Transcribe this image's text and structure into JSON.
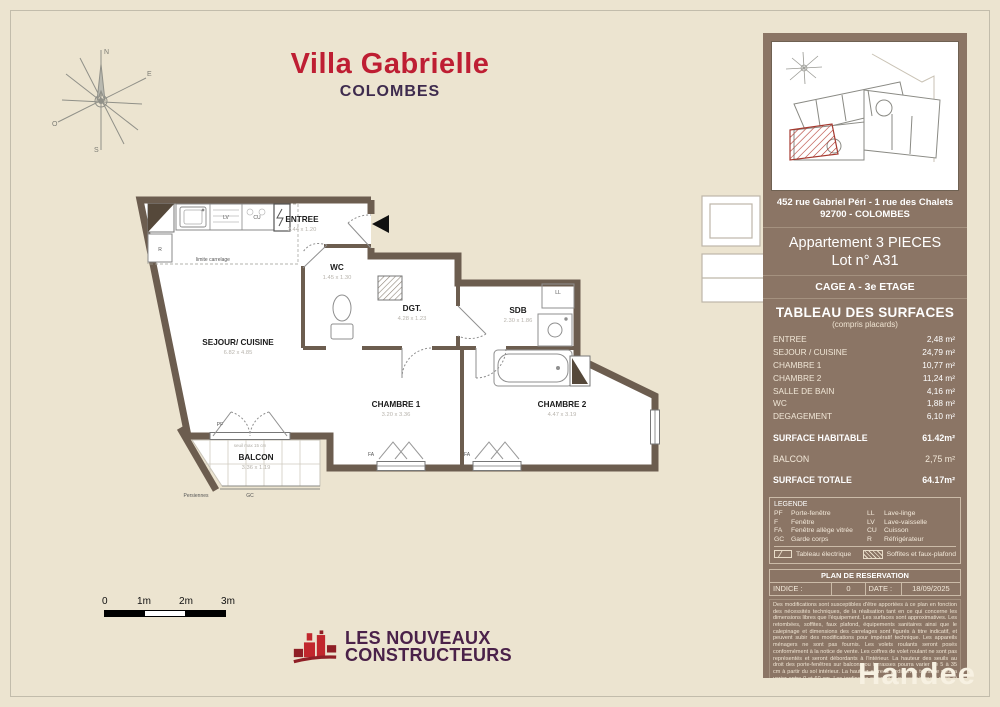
{
  "page": {
    "watermark": "Handee"
  },
  "header": {
    "title": "Villa Gabrielle",
    "subtitle": "COLOMBES"
  },
  "floorplan": {
    "rooms": [
      {
        "label": "ENTREE",
        "dims": "2.44 x 1.20"
      },
      {
        "label": "WC",
        "dims": "1.45 x 1.30"
      },
      {
        "label": "SEJOUR/ CUISINE",
        "dims": "6.82 x 4.85"
      },
      {
        "label": "DGT.",
        "dims": "4.28 x 1.23"
      },
      {
        "label": "SDB",
        "dims": "2.30 x 1.86"
      },
      {
        "label": "CHAMBRE 1",
        "dims": "3.20 x 3.36"
      },
      {
        "label": "CHAMBRE 2",
        "dims": "4.47 x 3.19"
      },
      {
        "label": "BALCON",
        "dims": "3.36 x 1.19"
      }
    ],
    "labels": {
      "lv": "LV",
      "cu": "CU",
      "r": "R",
      "ll": "LL",
      "pf": "PF",
      "gc": "GC",
      "fa1": "FA",
      "fa2": "FA",
      "limite": "limite carrelage",
      "seuil": "seuil max 15 cm",
      "persiennes": "Persiennes"
    }
  },
  "scalebar": {
    "t0": "0",
    "t1": "1m",
    "t2": "2m",
    "t3": "3m"
  },
  "logo": {
    "line1": "LES NOUVEAUX",
    "line2": "CONSTRUCTEURS"
  },
  "sidebar": {
    "address1": "452 rue Gabriel Péri - 1 rue des Chalets",
    "address2": "92700 - COLOMBES",
    "apartment": "Appartement 3 PIECES",
    "lot": "Lot n° A31",
    "stage": "CAGE A - 3e ETAGE",
    "surfaces": {
      "title": "TABLEAU DES SURFACES",
      "subtitle": "(compris placards)",
      "rows": [
        {
          "label": "ENTREE",
          "value": "2,48 m²"
        },
        {
          "label": "SEJOUR / CUISINE",
          "value": "24,79 m²"
        },
        {
          "label": "CHAMBRE 1",
          "value": "10,77 m²"
        },
        {
          "label": "CHAMBRE 2",
          "value": "11,24 m²"
        },
        {
          "label": "SALLE DE BAIN",
          "value": "4,16 m²"
        },
        {
          "label": "WC",
          "value": "1,88 m²"
        },
        {
          "label": "DEGAGEMENT",
          "value": "6,10 m²"
        }
      ],
      "habitable": {
        "label": "SURFACE HABITABLE",
        "value": "61.42m²"
      },
      "balcon": {
        "label": "BALCON",
        "value": "2,75 m²"
      },
      "totale": {
        "label": "SURFACE TOTALE",
        "value": "64.17m²"
      }
    },
    "legend": {
      "title": "LEGENDE",
      "items": [
        {
          "code": "PF",
          "label": "Porte-fenêtre"
        },
        {
          "code": "F",
          "label": "Fenêtre"
        },
        {
          "code": "FA",
          "label": "Fenêtre allège vitrée"
        },
        {
          "code": "GC",
          "label": "Garde corps"
        },
        {
          "code": "LL",
          "label": "Lave-linge"
        },
        {
          "code": "LV",
          "label": "Lave-vaisselle"
        },
        {
          "code": "CU",
          "label": "Cuisson"
        },
        {
          "code": "R",
          "label": "Réfrigérateur"
        }
      ],
      "electrical": "Tableau électrique",
      "soffites": "Soffites et faux-plafond"
    },
    "reservation": {
      "title": "PLAN DE RESERVATION",
      "indice_label": "INDICE :",
      "indice_value": "0",
      "date_label": "DATE :",
      "date_value": "18/09/2025"
    },
    "disclaimer": "Des modifications sont susceptibles d'être apportées à ce plan en fonction des nécessités techniques, de la réalisation tant en ce qui concerne les dimensions libres que l'équipement. Les surfaces sont approximatives. Les retombées, soffites, faux plafond, équipements sanitaires ainsi que le calepinage et dimensions des carrelages sont figurés à titre indicatif, et peuvent subir des modifications pour impératif technique. Les appareils ménagers ne sont pas fournis. Les volets roulants seront posés conformément à la notice de vente. Les coffres de volet roulant ne sont pas représentés et seront débordants à l'intérieur. La hauteur des seuils au droit des porte-fenêtres sur balcons ou terrasses pourra varier de 5 à 35 cm à partir du sol intérieur. La hauteur entre le jardin et la terrasse pourra varier entre 0 et 60 cm. Les jardins ne seront pas nécessairement plats et pourront comporter des talus et des pentes."
  }
}
